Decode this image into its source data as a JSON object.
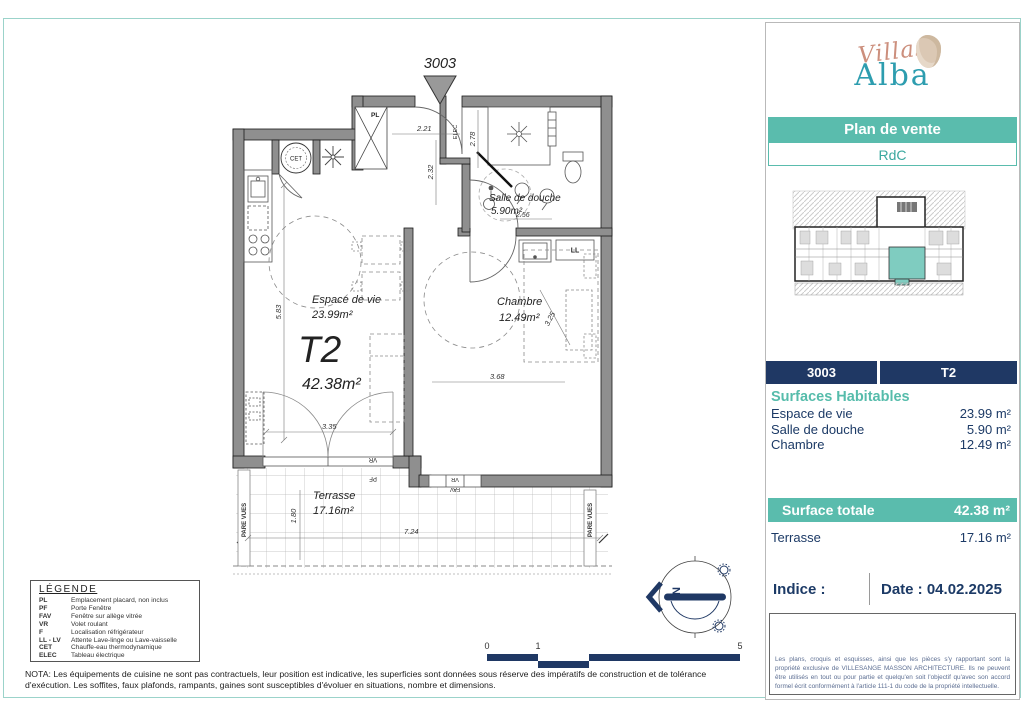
{
  "plan": {
    "unit_marker": "3003",
    "type_label": "T2",
    "type_area": "42.38m²",
    "rooms": {
      "espace": {
        "name": "Espace de vie",
        "area": "23.99m²"
      },
      "chambre": {
        "name": "Chambre",
        "area": "12.49m²"
      },
      "douche": {
        "name": "Salle de douche",
        "area": "5.90m²"
      },
      "terrasse": {
        "name": "Terrasse",
        "area": "17.16m²"
      }
    },
    "dims": {
      "hall_w": "2.21",
      "hall_h": "2.32",
      "douche_h": "2.78",
      "douche_w": "2.56",
      "sejour_h": "5.83",
      "sejour_w": "3.35",
      "chambre_w": "3.68",
      "chambre_diag": "3.25",
      "terrasse_w": "7.24",
      "terrasse_h": "1.80"
    },
    "tags": {
      "pl": "PL",
      "elec": "ELEC",
      "ll": "LL",
      "cet": "CET",
      "vr": "VR",
      "pf": "PF",
      "fav": "FAV",
      "pare_vues": "PARE VUES"
    },
    "compass_north": "N",
    "scale_ticks": {
      "t0": "0",
      "t1": "1",
      "t5": "5"
    }
  },
  "legend": {
    "title": "LÉGENDE",
    "items": [
      {
        "abbr": "PL",
        "label": "Emplacement placard, non inclus"
      },
      {
        "abbr": "PF",
        "label": "Porte Fenêtre"
      },
      {
        "abbr": "FAV",
        "label": "Fenêtre sur allège vitrée"
      },
      {
        "abbr": "VR",
        "label": "Volet roulant"
      },
      {
        "abbr": "F",
        "label": "Localisation réfrigérateur"
      },
      {
        "abbr": "LL - LV",
        "label": "Attente Lave-linge ou Lave-vaisselle"
      },
      {
        "abbr": "CET",
        "label": "Chauffe-eau thermodynamique"
      },
      {
        "abbr": "ELEC",
        "label": "Tableau électrique"
      }
    ]
  },
  "nota": "NOTA: Les équipements de cuisine ne sont pas contractuels, leur position est indicative, les superficies sont données sous réserve des impératifs de construction et de tolérance d'exécution. Les soffites, faux plafonds, rampants, gaines sont susceptibles d'évoluer en situations, nombre et dimensions.",
  "sidebar": {
    "brand": {
      "line1": "Villas",
      "line2": "Alba"
    },
    "banner": "Plan de vente",
    "level": "RdC",
    "unit_number": "3003",
    "unit_type": "T2",
    "surfaces_title": "Surfaces Habitables",
    "surfaces": [
      {
        "label": "Espace de vie",
        "value": "23.99 m²"
      },
      {
        "label": "Salle de douche",
        "value": "5.90 m²"
      },
      {
        "label": "Chambre",
        "value": "12.49 m²"
      }
    ],
    "total": {
      "label": "Surface totale",
      "value": "42.38 m²"
    },
    "terrasse": {
      "label": "Terrasse",
      "value": "17.16 m²"
    },
    "indice_label": "Indice :",
    "date_label": "Date : 04.02.2025",
    "legal": "Les plans, croquis et esquisses, ainsi que les pièces s'y rapportant sont la propriété exclusive de VILLESANGE MASSON ARCHITECTURE. Ils ne peuvent être utilisés en tout ou pour partie et quelqu'en soit l'objectif qu'avec son accord formel écrit conformément à l'article 111-1 du code de la propriété intellectuelle."
  },
  "colors": {
    "teal": "#5abcad",
    "navy": "#1f3864",
    "wall_gray": "#8f8f8f",
    "logo_coral": "#cc8f7d",
    "logo_teal": "#2d9daf",
    "frame_teal": "#9bd3ca",
    "highlight_unit": "#7fccc0"
  }
}
